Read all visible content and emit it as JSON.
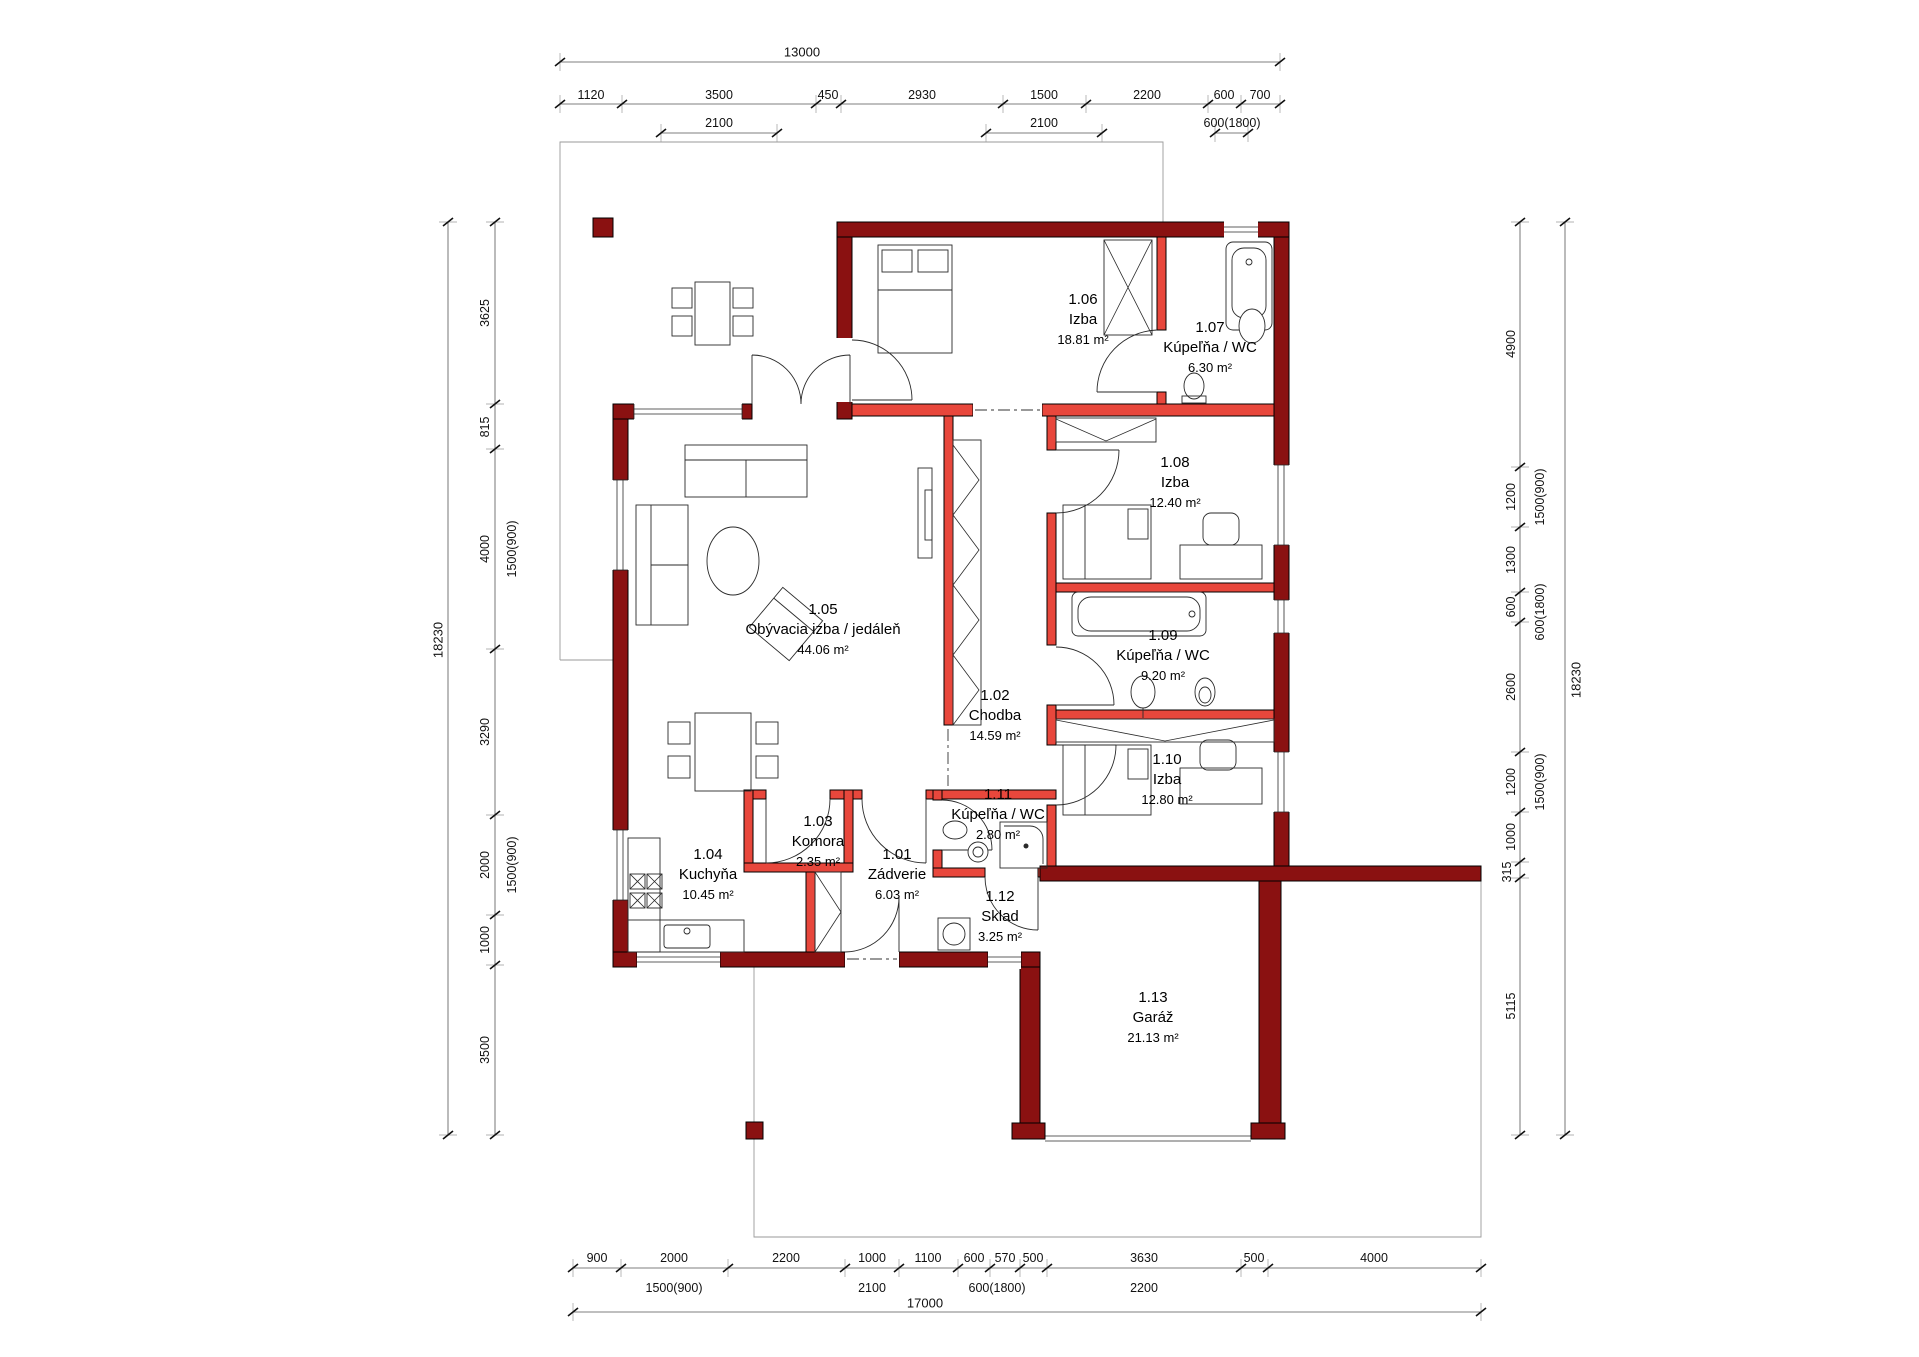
{
  "colors": {
    "exterior_wall": "#8A1111",
    "interior_wall": "#E8473C",
    "line": "#2a2a2a"
  },
  "rooms": [
    {
      "id": "1.01",
      "name": "Zádverie",
      "area": "6.03 m²"
    },
    {
      "id": "1.02",
      "name": "Chodba",
      "area": "14.59 m²"
    },
    {
      "id": "1.03",
      "name": "Komora",
      "area": "2.35 m²"
    },
    {
      "id": "1.04",
      "name": "Kuchyňa",
      "area": "10.45 m²"
    },
    {
      "id": "1.05",
      "name": "Obývacia izba / jedáleň",
      "area": "44.06 m²"
    },
    {
      "id": "1.06",
      "name": "Izba",
      "area": "18.81 m²"
    },
    {
      "id": "1.07",
      "name": "Kúpeľňa / WC",
      "area": "6.30 m²"
    },
    {
      "id": "1.08",
      "name": "Izba",
      "area": "12.40 m²"
    },
    {
      "id": "1.09",
      "name": "Kúpeľňa / WC",
      "area": "9.20 m²"
    },
    {
      "id": "1.10",
      "name": "Izba",
      "area": "12.80 m²"
    },
    {
      "id": "1.11",
      "name": "Kúpeľňa / WC",
      "area": "2.80 m²"
    },
    {
      "id": "1.12",
      "name": "Sklad",
      "area": "3.25 m²"
    },
    {
      "id": "1.13",
      "name": "Garáž",
      "area": "21.13 m²"
    }
  ],
  "dims": {
    "top_overall": "13000",
    "top_row": [
      "1120",
      "3500",
      "450",
      "2930",
      "1500",
      "2200",
      "600",
      "700"
    ],
    "top_sub": [
      "2100",
      "2100",
      "600(1800)"
    ],
    "left_overall": "18230",
    "left_row": [
      "3625",
      "815",
      "4000",
      "3290",
      "2000",
      "1000",
      "3500"
    ],
    "left_sub": [
      "1500(900)",
      "1500(900)"
    ],
    "right_overall": "18230",
    "right_row": [
      "4900",
      "1200",
      "1300",
      "600",
      "2600",
      "1200",
      "1000",
      "315",
      "5115"
    ],
    "right_sub": [
      "1500(900)",
      "600(1800)",
      "1500(900)"
    ],
    "bottom_overall": "17000",
    "bottom_row": [
      "900",
      "2000",
      "2200",
      "1000",
      "1100",
      "600",
      "570",
      "500",
      "3630",
      "500",
      "4000"
    ],
    "bottom_sub": [
      "1500(900)",
      "2100",
      "600(1800)",
      "2200"
    ]
  }
}
